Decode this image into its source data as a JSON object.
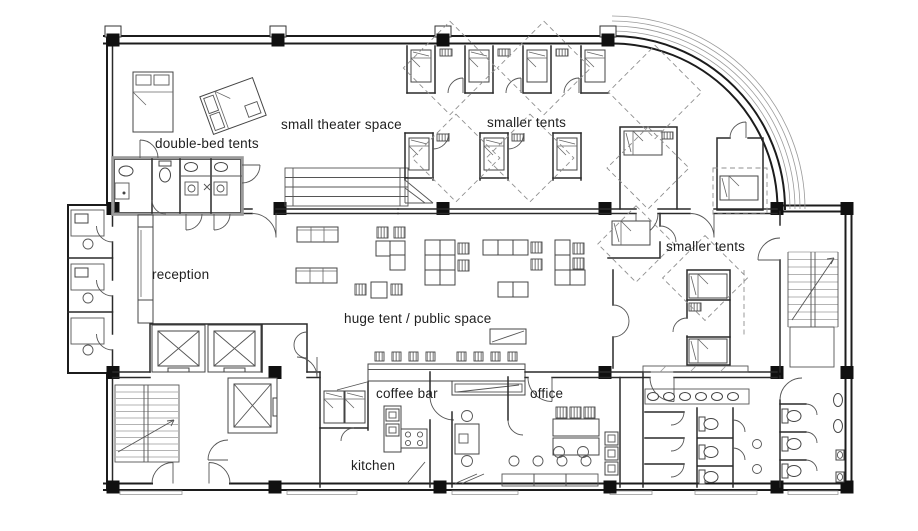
{
  "labels": {
    "double_bed_tents": "double-bed tents",
    "small_theater_space": "small theater space",
    "smaller_tents_top": "smaller tents",
    "smaller_tents_right": "smaller tents",
    "reception": "reception",
    "huge_tent_public_space": "huge tent / public space",
    "coffee_bar": "coffee bar",
    "office": "office",
    "kitchen": "kitchen"
  },
  "colors": {
    "background": "#ffffff",
    "walls": "#1c1c1c",
    "light_lines": "#9a9a9a",
    "columns": "#101010",
    "text": "#1f1f1f"
  }
}
